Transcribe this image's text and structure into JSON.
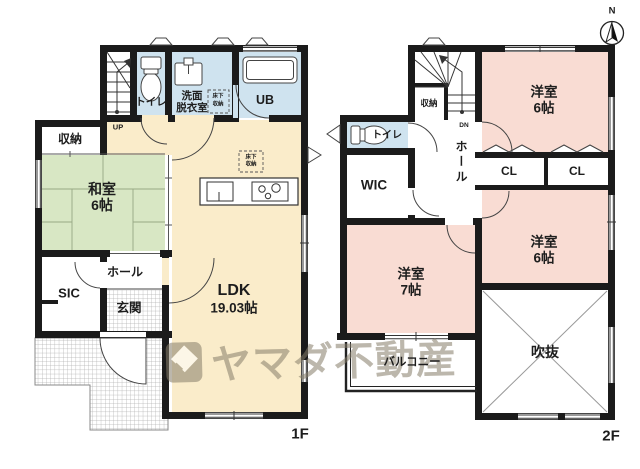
{
  "watermark": {
    "brand": "ヤマダ不動産"
  },
  "compass": {
    "label": "N"
  },
  "colors": {
    "wall": "#1b1b1b",
    "floor_cream": "#faecca",
    "tatami_green": "#d8e7c4",
    "wet_blue": "#cfe3ef",
    "room_pink": "#f9dcd3",
    "watermark": "#877e6a"
  },
  "floor1": {
    "floor_label": "1F",
    "stairs_label": "UP",
    "rooms": {
      "shuno": "収納",
      "toilet": "トイレ",
      "senmen_l1": "洗面",
      "senmen_l2": "脱衣室",
      "yukashita_l1": "床下",
      "yukashita_l2": "収納",
      "ub": "UB",
      "washitsu_name": "和室",
      "washitsu_size": "6帖",
      "ldk_name": "LDK",
      "ldk_size": "19.03帖",
      "ldk_yukashita_l1": "床下",
      "ldk_yukashita_l2": "収納",
      "hall": "ホール",
      "sic": "SIC",
      "genkan": "玄関"
    }
  },
  "floor2": {
    "floor_label": "2F",
    "stairs_label": "DN",
    "rooms": {
      "shuno": "収納",
      "toilet": "トイレ",
      "wic": "WIC",
      "hall": "ホール",
      "yoshitsu_a_name": "洋室",
      "yoshitsu_a_size": "6帖",
      "cl_a": "CL",
      "cl_b": "CL",
      "yoshitsu_b_name": "洋室",
      "yoshitsu_b_size": "6帖",
      "yoshitsu_c_name": "洋室",
      "yoshitsu_c_size": "7帖",
      "fukinuke": "吹抜",
      "balcony": "バルコニー"
    }
  }
}
